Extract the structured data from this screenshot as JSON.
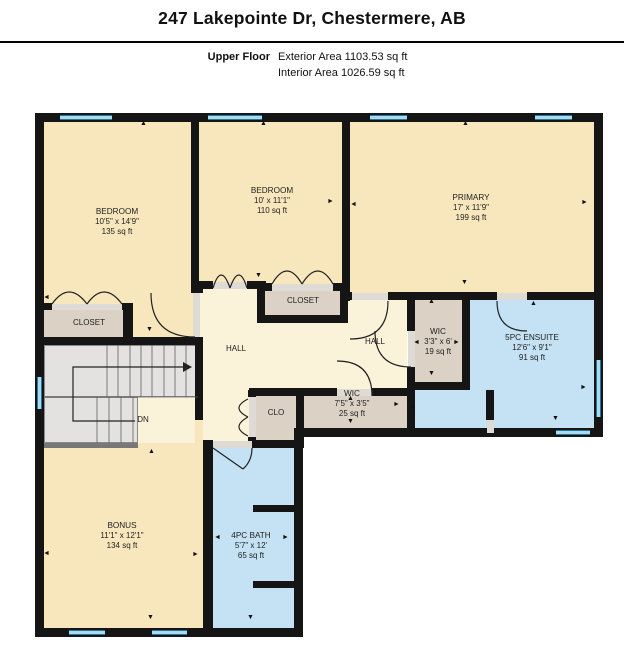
{
  "header": {
    "title": "247 Lakepointe Dr, Chestermere, AB",
    "floor_label": "Upper Floor",
    "exterior_area": "Exterior Area 1103.53 sq ft",
    "interior_area": "Interior Area 1026.59 sq ft"
  },
  "rooms": {
    "bedroom1": {
      "name": "BEDROOM",
      "dim": "10'5\" x 14'9\"",
      "area": "135 sq ft"
    },
    "bedroom2": {
      "name": "BEDROOM",
      "dim": "10' x 11'1\"",
      "area": "110 sq ft"
    },
    "primary": {
      "name": "PRIMARY",
      "dim": "17' x 11'9\"",
      "area": "199 sq ft"
    },
    "ensuite": {
      "name": "5PC ENSUITE",
      "dim": "12'6\" x 9'1\"",
      "area": "91 sq ft"
    },
    "wic1": {
      "name": "WIC",
      "dim": "3'3\" x 6'",
      "area": "19 sq ft"
    },
    "wic2": {
      "name": "WIC",
      "dim": "7'5\" x 3'5\"",
      "area": "25 sq ft"
    },
    "bonus": {
      "name": "BONUS",
      "dim": "11'1\" x 12'1\"",
      "area": "134 sq ft"
    },
    "bath": {
      "name": "4PC BATH",
      "dim": "5'7\" x 12'",
      "area": "65 sq ft"
    },
    "closet1": {
      "name": "CLOSET"
    },
    "closet2": {
      "name": "CLOSET"
    },
    "hall1": {
      "name": "HALL"
    },
    "hall2": {
      "name": "HALL"
    },
    "clo": {
      "name": "CLO"
    },
    "stairs": {
      "name": "DN"
    }
  },
  "icons": {
    "arrow_up": "▲",
    "arrow_down": "▼",
    "arrow_left": "◄",
    "arrow_right": "►"
  },
  "colors": {
    "wall": "#151515",
    "warm": "#F8E7BD",
    "hall": "#FBF2DA",
    "closet": "#DBD2C5",
    "bath": "#C4E2F3",
    "stair": "#E3E2E0",
    "win-l": "#ADD9EC",
    "win-d": "#2278A0",
    "gap": "#DEDBD4"
  }
}
